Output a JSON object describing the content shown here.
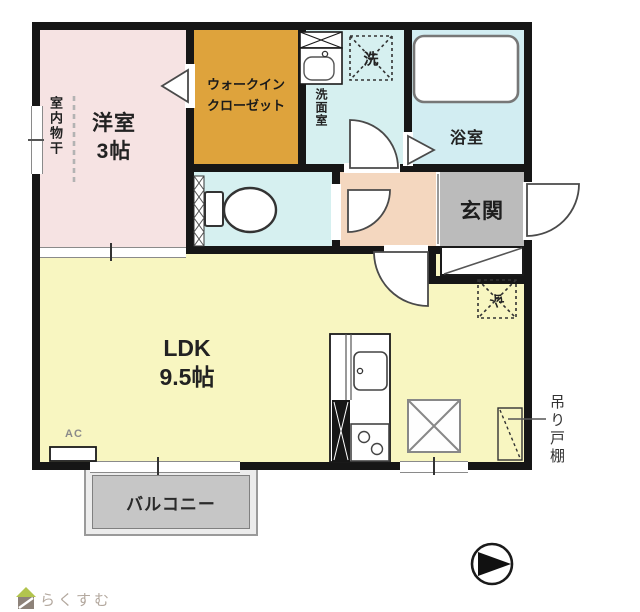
{
  "rooms": {
    "yoshitsu": {
      "label": "洋室",
      "size": "3帖"
    },
    "wic": {
      "line1": "ウォークイン",
      "line2": "クローゼット"
    },
    "senmen": {
      "label": "洗面室"
    },
    "yokushitsu": {
      "label": "浴室"
    },
    "genkan": {
      "label": "玄関"
    },
    "ldk": {
      "label": "LDK",
      "size": "9.5帖"
    },
    "balcony": {
      "label": "バルコニー"
    }
  },
  "annotations": {
    "indoor_drying": "室内物干",
    "washer": "洗",
    "fridge": "冷",
    "ac": "AC",
    "hanging_cupboard": "吊り戸棚"
  },
  "branding": {
    "logo_text": "らくすむ"
  },
  "colors": {
    "wall": "#161616",
    "yoshitsu_pink": "#f6e3e3",
    "wic_orange": "#dea33c",
    "wet_area_cyan": "#d6f0f0",
    "bath_cyan": "#d2edf2",
    "ldk_yellow": "#f8f6c1",
    "hall_peach": "#f4d7bf",
    "genkan_gray": "#bbbbbb",
    "balcony_gray": "#c6c6c6",
    "logo_green": "#b2c44e",
    "logo_text_gray": "#b3a89e"
  }
}
